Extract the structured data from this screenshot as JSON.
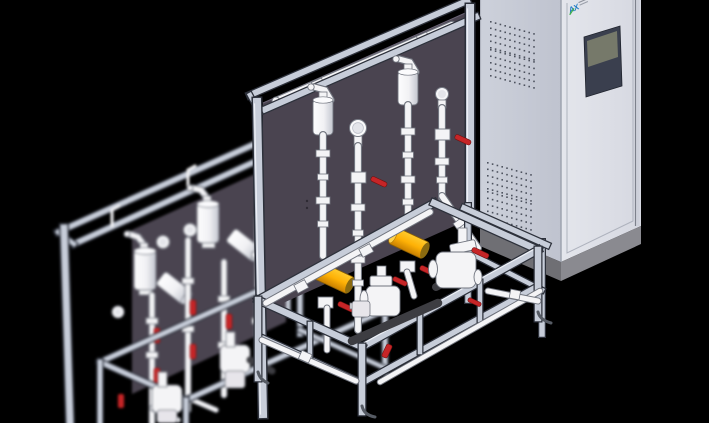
{
  "scene": {
    "description": "3D CAD render: two chemical dosing skids (aluminium profile frames, dark mounting panels, white piping with red ball valves, yellow pulsation dampeners, diaphragm metering pumps) beside an electrical control cabinet with HMI screen",
    "background": "#000000"
  },
  "cabinet": {
    "logo_mark": "AX",
    "vents": {
      "clusters": [
        {
          "x": 490,
          "y": 21
        },
        {
          "x": 490,
          "y": 49
        },
        {
          "x": 487,
          "y": 162
        },
        {
          "x": 487,
          "y": 191
        }
      ],
      "rows": 5,
      "cols": 10,
      "dx": 4.8,
      "dy": 6.5,
      "shear": 0.28,
      "size": 1.6
    }
  },
  "colors": {
    "bg": "#000000",
    "frame": "#c7cdd9",
    "frameEdge": "#2d313b",
    "frameHi": "#edf0f6",
    "panel": "#4a4450",
    "pipe": "#f4f4f6",
    "pipeEdge": "#71757f",
    "darkPipe": "#3d3d42",
    "valveRed": "#c62527",
    "yellow": "#ffb60a",
    "yellowDeep": "#c87f00",
    "cabSide": "#c7cbd6",
    "cabFront": "#e0e2e9",
    "cabBase": "#6f6f74",
    "cabBase2": "#8a8a90",
    "cabEdge": "#9aa0ac",
    "screenBezel": "#3a3f4e",
    "screenLcd": "#76796a",
    "logoBlue": "#1f7dc4",
    "logoGreen": "#3fae49",
    "vent": "#4d525e"
  }
}
